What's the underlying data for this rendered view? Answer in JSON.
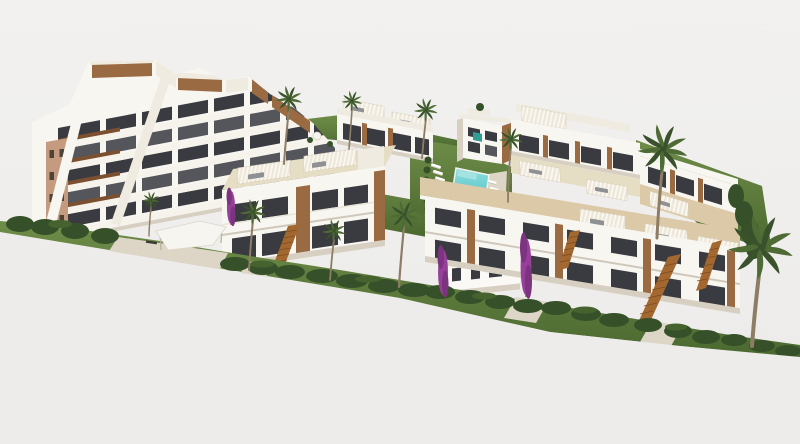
{
  "meta": {
    "content_type": "3D architectural rendering",
    "view": "aerial three-quarter view",
    "subject": "modern Mediterranean residential development with terraced apartment block, townhouse rows, pool courtyard and palm trees",
    "visible_text": "none"
  },
  "palette": {
    "background": "#f0efed",
    "wall_white": "#f8f6f1",
    "wall_white_shaded": "#efebe0",
    "shadow_face": "#d7d0c2",
    "roof_deck": "#e6ddc5",
    "roof_deck_warm": "#dbc9a7",
    "wood_accent": "#9a6a42",
    "wood_dark": "#7a5030",
    "glazing_dark": "#3a3b40",
    "glazing_mid": "#55565c",
    "gable_tan": "#c49b7f",
    "grass_light": "#6f8d48",
    "grass_dark": "#4b6830",
    "hedge": "#36512a",
    "pool_water": "#5ec5c9",
    "pool_light": "#a5e3e3",
    "palm_frond": "#4e6b35",
    "palm_frond_dark": "#39522b",
    "palm_trunk": "#8d7d64",
    "stair_wood": "#a2682f",
    "walkway": "#ddd6c6",
    "bougainvillea": "#97409a",
    "tower_sign_teal": "#2f9e94",
    "furniture_gray": "#8f9094"
  },
  "scene": {
    "background": "plain light-gray studio backdrop, no sky or horizon line",
    "site_edge": "development sits on a diagonal plinth running from the left edge down toward the lower right corner",
    "buildings": [
      {
        "name": "apartment-block-left",
        "stories": 4,
        "features": [
          "stepped white balcony terraces",
          "wood-clad penthouse boxes along the roofline",
          "tan gable end wall with 8 small windows",
          "dark glazing bands",
          "diagonal white parapets"
        ]
      },
      {
        "name": "townhouse-row-front-left",
        "stories": 2,
        "features": [
          "rooftop terrace with slatted pergolas",
          "gray outdoor lounge furniture",
          "external wood staircase to roof",
          "vertical wood accent panels",
          "dark full-height glazing"
        ]
      },
      {
        "name": "townhouse-row-rear-center",
        "stories": 2,
        "features": [
          "rooftop pergolas",
          "lawn strip with parasol in front"
        ]
      },
      {
        "name": "center-tower",
        "stories": 3,
        "features": [
          "teal sign panel on facade",
          "wood side panel",
          "roof shrub"
        ]
      },
      {
        "name": "townhouse-row-rear-right",
        "stories": 2,
        "features": [
          "stepped roof decks descending to the right",
          "pergolas with loungers",
          "hedge wall at far end"
        ]
      },
      {
        "name": "townhouse-row-front-right",
        "stories": 2,
        "features": [
          "long stepped balcony band",
          "three external wood staircases",
          "hedge-lined front gardens"
        ]
      },
      {
        "name": "rear-facade-building-front-center",
        "stories": 2,
        "features": [
          "plain white facade with 8 small dark windows",
          "rooftop pergola terrace",
          "bougainvillea plants on both sides"
        ]
      }
    ],
    "amenities": {
      "swimming_pool": {
        "shape": "rectangular",
        "water_color_ref": "pool_water",
        "deck": "white sun deck on the right side"
      },
      "sun_loungers": {
        "count": 11,
        "color": "#ffffff",
        "location": "lawn left of pool and on pool deck"
      },
      "shade_sail_carport": {
        "location": "in front of left apartment block"
      },
      "benches": 1
    },
    "vegetation": {
      "palm_trees": 10,
      "bougainvillea_plants": 3,
      "hedge_rows": "dark clipped hedges along all garden edges",
      "lawns": "bright green lawn strips between the rows"
    }
  }
}
